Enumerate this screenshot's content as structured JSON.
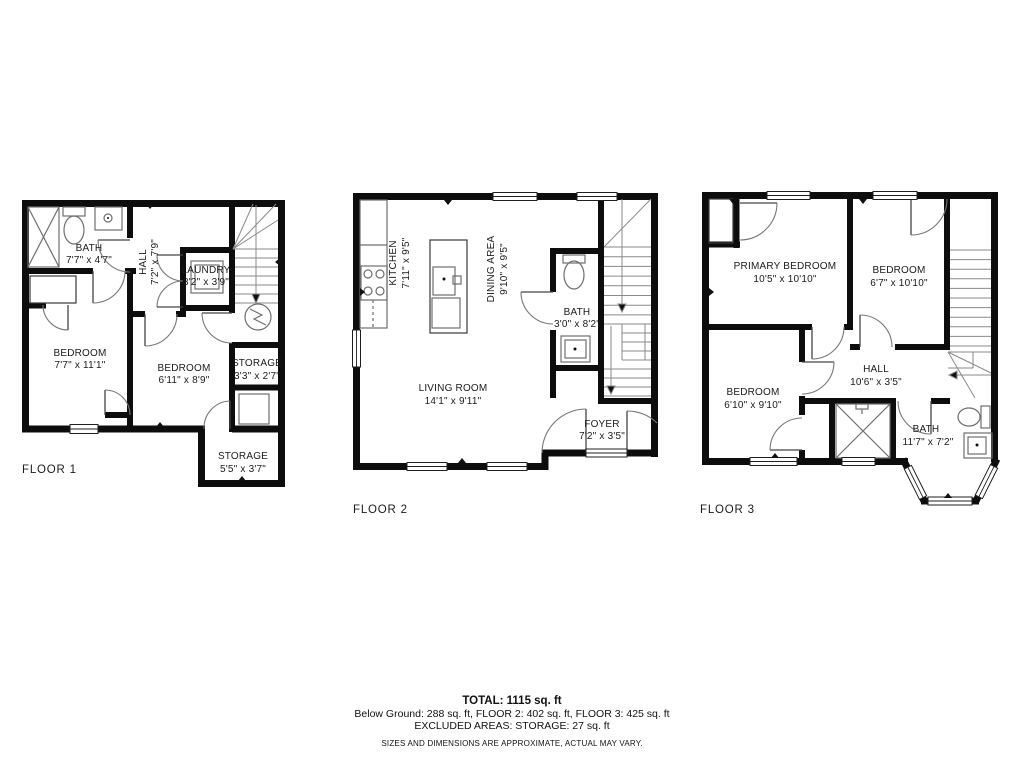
{
  "floors": [
    {
      "label": "FLOOR 1",
      "rooms": [
        {
          "name": "BATH",
          "dims": "7'7\" x 4'7\""
        },
        {
          "name": "HALL",
          "dims": "7'2\" x 7'9\""
        },
        {
          "name": "LAUNDRY",
          "dims": "3'2\" x 3'9\""
        },
        {
          "name": "BEDROOM",
          "dims": "7'7\" x 11'1\""
        },
        {
          "name": "BEDROOM",
          "dims": "6'11\" x 8'9\""
        },
        {
          "name": "STORAGE",
          "dims": "3'3\" x 2'7\""
        },
        {
          "name": "STORAGE",
          "dims": "5'5\" x 3'7\""
        }
      ]
    },
    {
      "label": "FLOOR 2",
      "rooms": [
        {
          "name": "KITCHEN",
          "dims": "7'11\" x 9'5\""
        },
        {
          "name": "DINING AREA",
          "dims": "9'10\" x 9'5\""
        },
        {
          "name": "BATH",
          "dims": "3'0\" x 8'2\""
        },
        {
          "name": "LIVING ROOM",
          "dims": "14'1\" x 9'11\""
        },
        {
          "name": "FOYER",
          "dims": "7'2\" x 3'5\""
        }
      ]
    },
    {
      "label": "FLOOR 3",
      "rooms": [
        {
          "name": "PRIMARY BEDROOM",
          "dims": "10'5\" x 10'10\""
        },
        {
          "name": "BEDROOM",
          "dims": "6'7\" x 10'10\""
        },
        {
          "name": "HALL",
          "dims": "10'6\" x 3'5\""
        },
        {
          "name": "BEDROOM",
          "dims": "6'10\" x 9'10\""
        },
        {
          "name": "BATH",
          "dims": "11'7\" x 7'2\""
        }
      ]
    }
  ],
  "summary": {
    "total": "TOTAL: 1115 sq. ft",
    "breakdown": "Below Ground: 288 sq. ft, FLOOR 2: 402 sq. ft, FLOOR 3: 425 sq. ft",
    "excluded": "EXCLUDED AREAS: STORAGE: 27 sq. ft",
    "disclaimer": "SIZES AND DIMENSIONS ARE APPROXIMATE, ACTUAL MAY VARY."
  },
  "colors": {
    "wall": "#0d0d0d",
    "fixture_line": "#6e6e6e",
    "text": "#1b1b1b",
    "background": "#ffffff"
  }
}
